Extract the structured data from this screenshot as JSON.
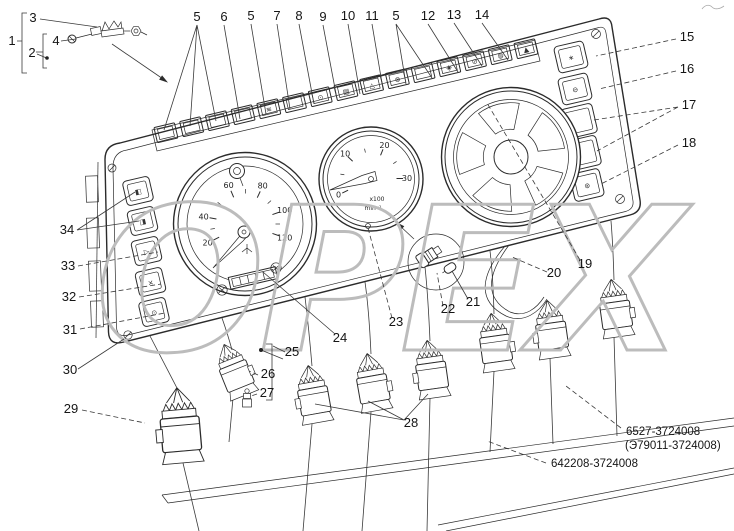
{
  "watermark": {
    "text": "ОРЕХ",
    "color": "#bcbcbc"
  },
  "part_numbers": [
    {
      "text": "6527-3724008"
    },
    {
      "text": "(Э79011-3724008)"
    },
    {
      "text": "642208-3724008"
    }
  ],
  "callouts": [
    {
      "t": "1",
      "x": 12,
      "y": 45
    },
    {
      "t": "3",
      "x": 33,
      "y": 22
    },
    {
      "t": "4",
      "x": 56,
      "y": 45
    },
    {
      "t": "2",
      "x": 32,
      "y": 57
    },
    {
      "t": "5",
      "x": 197,
      "y": 21
    },
    {
      "t": "6",
      "x": 224,
      "y": 21
    },
    {
      "t": "5",
      "x": 251,
      "y": 20
    },
    {
      "t": "7",
      "x": 277,
      "y": 20
    },
    {
      "t": "8",
      "x": 299,
      "y": 20
    },
    {
      "t": "9",
      "x": 323,
      "y": 21
    },
    {
      "t": "10",
      "x": 348,
      "y": 20
    },
    {
      "t": "11",
      "x": 372,
      "y": 20
    },
    {
      "t": "5",
      "x": 396,
      "y": 20
    },
    {
      "t": "12",
      "x": 428,
      "y": 20
    },
    {
      "t": "13",
      "x": 454,
      "y": 19
    },
    {
      "t": "14",
      "x": 482,
      "y": 19
    },
    {
      "t": "15",
      "x": 687,
      "y": 41
    },
    {
      "t": "16",
      "x": 687,
      "y": 73
    },
    {
      "t": "17",
      "x": 689,
      "y": 109
    },
    {
      "t": "18",
      "x": 689,
      "y": 147
    },
    {
      "t": "19",
      "x": 585,
      "y": 268
    },
    {
      "t": "20",
      "x": 554,
      "y": 277
    },
    {
      "t": "21",
      "x": 473,
      "y": 306
    },
    {
      "t": "22",
      "x": 448,
      "y": 313
    },
    {
      "t": "23",
      "x": 396,
      "y": 326
    },
    {
      "t": "24",
      "x": 340,
      "y": 342
    },
    {
      "t": "25",
      "x": 292,
      "y": 356
    },
    {
      "t": "26",
      "x": 268,
      "y": 378
    },
    {
      "t": "27",
      "x": 267,
      "y": 397
    },
    {
      "t": "28",
      "x": 411,
      "y": 427
    },
    {
      "t": "29",
      "x": 71,
      "y": 413
    },
    {
      "t": "30",
      "x": 70,
      "y": 374
    },
    {
      "t": "31",
      "x": 70,
      "y": 334
    },
    {
      "t": "32",
      "x": 69,
      "y": 301
    },
    {
      "t": "33",
      "x": 68,
      "y": 270
    },
    {
      "t": "34",
      "x": 67,
      "y": 234
    }
  ],
  "speedometer": {
    "labels": [
      "20",
      "40",
      "60",
      "80",
      "100",
      "120"
    ]
  },
  "tachometer": {
    "labels": [
      "0",
      "10",
      "20",
      "30"
    ],
    "note1": "x100",
    "note2": "min⁻¹"
  },
  "indicator_strip": {
    "count": 15,
    "icons": [
      "",
      "",
      "",
      "",
      "≋",
      "",
      "⊙",
      "▤",
      "△",
      "⊗",
      "",
      "◈",
      "⊘",
      "◍",
      "▲"
    ]
  },
  "left_buttons": {
    "icons": [
      "◧",
      "◨",
      "▷",
      "×",
      "⊙"
    ]
  },
  "right_buttons": {
    "icons": [
      "∗",
      "⊖",
      "",
      "",
      "⊛"
    ]
  }
}
